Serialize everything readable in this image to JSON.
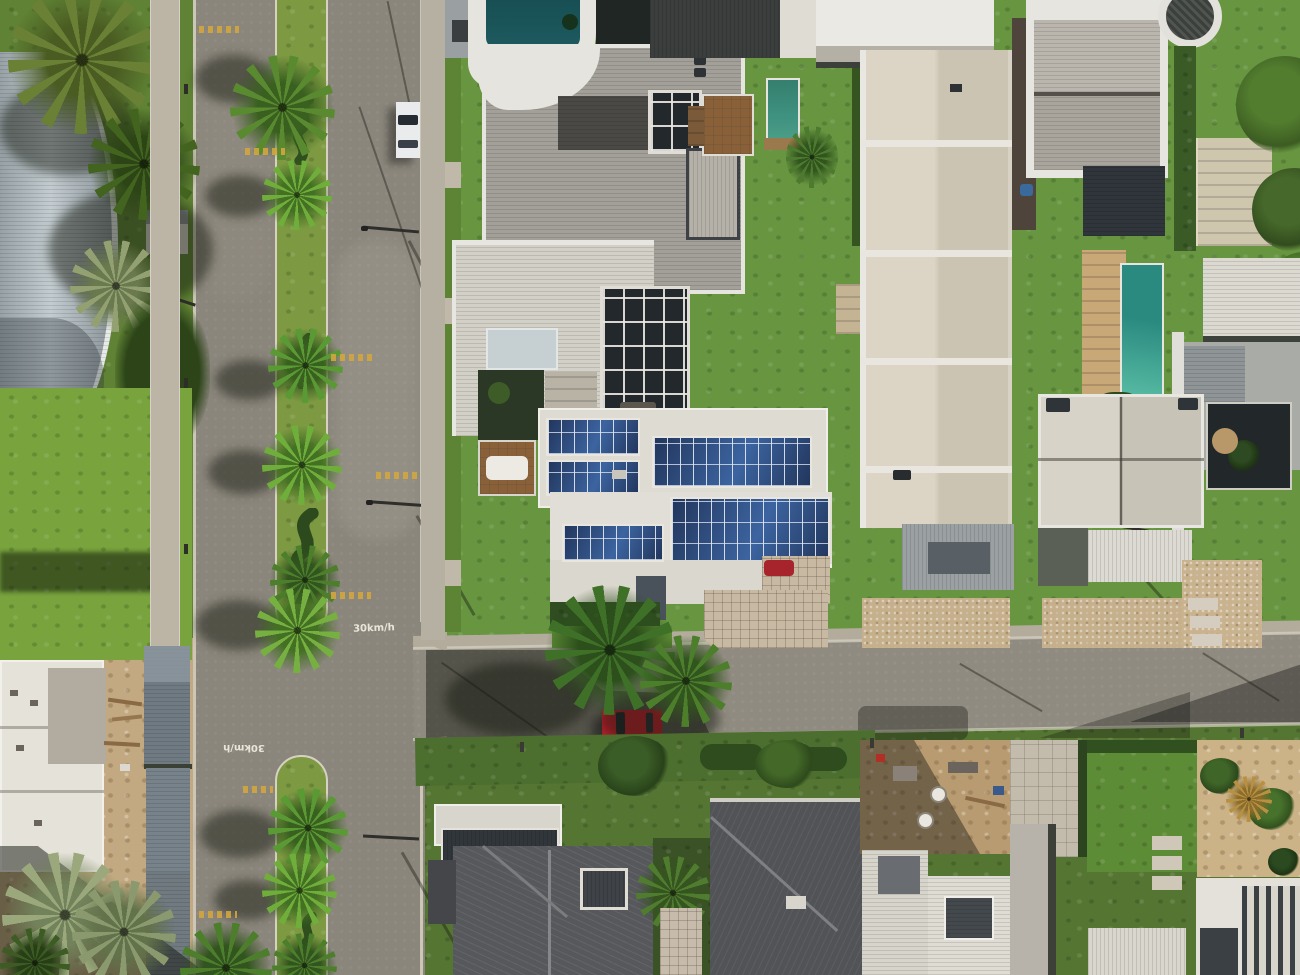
{
  "meta": {
    "type": "aerial-photograph",
    "view": "top-down drone view, midday sun from upper right, long shadows to lower-left",
    "subject": "Modern coastal residential neighborhood with a palm-lined divided avenue, a tee cross street, white flat-roofed houses, rooftop solar panel arrays, swimming pools, lawns and a construction lot"
  },
  "roads": {
    "avenue": {
      "orientation": "vertical, left third of frame",
      "type": "divided avenue",
      "median": "grass median planted with palm trees and serpentine topiary hedges",
      "speed_limit_text": "30km/h",
      "marking_occurrences": 2,
      "rumble_strip_count": 7
    },
    "cross_street": {
      "orientation": "horizontal, lower third, slight upward slant to the right",
      "joins": "tee intersection with median break"
    }
  },
  "vehicles": {
    "white_car": {
      "color": "#e9ebec",
      "location": "driving in right lane of avenue, upper left"
    },
    "red_car_street": {
      "color": "#bf1f2b",
      "location": "parked on cross street below solar house"
    },
    "red_car_driveway": {
      "color": "#a8242c",
      "location": "in carport notch of solar house driveway"
    }
  },
  "features": {
    "solar_arrays": 6,
    "pools": [
      "dark teal rooftop plunge pool",
      "small green garden lap pool",
      "teal lap pool with timber deck (right)"
    ],
    "landmarks": [
      "curved corrugated roof building top-left",
      "circular tower top-right",
      "serpentine hedges in median",
      "house under construction bottom-left",
      "charcoal hip-roof houses bottom-center"
    ]
  },
  "palette": {
    "sidewalk": "#b3ac9c",
    "concrete": "#bcb5a6",
    "asphalt": "#8b867c",
    "asphaltLight": "#979285",
    "lineWhite": "#d6d1c3",
    "lineYellow": "#d2a63e",
    "grassBase": "#679540",
    "grassBright": "#78a33d",
    "grassMid": "#5f8234",
    "grassDark": "#4c6e2e",
    "hedgeDark": "#2f4d20",
    "palmGreen": "#4c7e2c",
    "palmBright": "#6fae3a",
    "palmOlive": "#6a8034",
    "palmSage": "#93a072",
    "palmGold": "#b89040",
    "roofWhite": "#e6e4de",
    "roofBright": "#eae9e4",
    "roofPale": "#d3d0c7",
    "roofCream": "#dcd5c6",
    "roofCreamDark": "#ccc4b2",
    "roofShingle": "#a39f99",
    "roofGrayBlue": "#6f7a82",
    "roofSlate": "#56585c",
    "roofCharcoal": "#3a3e3d",
    "roofDark2": "#515356",
    "windowDark": "#22282c",
    "solarA": "#3c64a0",
    "solarB": "#22365c",
    "poolDark": "#1d5a5f",
    "poolTeal": "#2a8a80",
    "poolAqua": "#5bbfa6",
    "poolGreen": "#3f9180",
    "sand": "#c3a981",
    "dirt": "#b99b72",
    "paver": "#c8b9a2",
    "gravel": "#c6b08c",
    "wood": "#8a6038",
    "woodDeck": "#c9a878",
    "steelBlue": "#aeb8bc",
    "carWhite": "#e9ebec",
    "carRed": "#bf1f2b",
    "metalDark": "#2e2e2a"
  }
}
